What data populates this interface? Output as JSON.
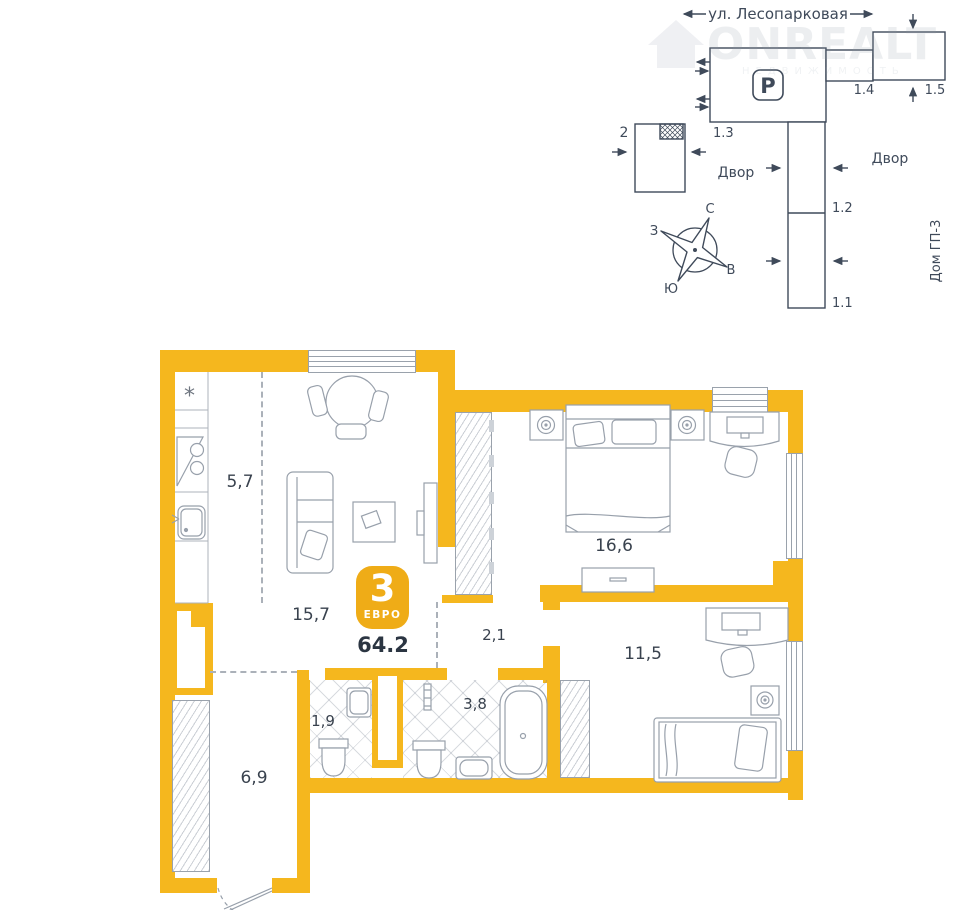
{
  "watermark": {
    "brand": "ONREALT",
    "tagline": "НЕДВИЖИМОСТЬ"
  },
  "site": {
    "street": "ул. Лесопарковая",
    "yard_left": "Двор",
    "yard_right": "Двор",
    "gp3": "Дом ГП-3",
    "buildings": {
      "b11": "1.1",
      "b12": "1.2",
      "b13": "1.3",
      "b14": "1.4",
      "b15": "1.5",
      "b2": "2"
    },
    "parking": "P",
    "compass": {
      "n": "С",
      "s": "Ю",
      "w": "З",
      "e": "В"
    }
  },
  "plan": {
    "badge_rooms": "3",
    "badge_type": "ЕВРО",
    "total_area": "64.2",
    "areas": {
      "kitchen": "5,7",
      "living": "15,7",
      "bedroom": "16,6",
      "corridor": "2,1",
      "room2": "11,5",
      "wc": "1,9",
      "bath": "3,8",
      "hall": "6,9"
    },
    "fridge_icon": "*"
  },
  "colors": {
    "wall": "#F5B71E",
    "badge": "#EFAC17",
    "dark_text": "#39424E",
    "site_line": "#3F4A5A",
    "furniture_line": "#98A0AB"
  }
}
